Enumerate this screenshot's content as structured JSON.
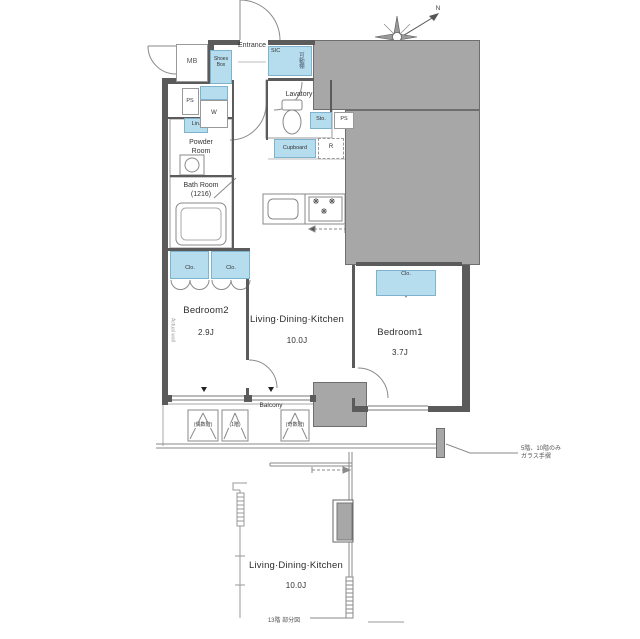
{
  "colors": {
    "wall": "#5b5b5b",
    "gray": "#a7a7a7",
    "blue": "#b6ddee",
    "blueBorder": "#7fb2cc",
    "line": "#8a8a8a",
    "text": "#333333"
  },
  "compass": {
    "north_label": "N"
  },
  "upper_plan": {
    "entrance": "Entrance",
    "mb": "MB",
    "shoes_box": "Shoes Box",
    "sic": "SIC",
    "sic_shelf": "可動棚",
    "lavatory": "Lavatory",
    "ps_left": "PS",
    "ps_right": "PS",
    "washer": "W",
    "linen": "Lin.",
    "powder_room": "Powder\nRoom",
    "bath_room": "Bath Room\n(1216)",
    "storage": "Sto.",
    "cupboard": "Cupboard",
    "fridge": "R",
    "burner_glyph": "❋",
    "closet_b2_left": "Clo.",
    "closet_b2_right": "Clo.",
    "closet_b1": "Clo.",
    "bedroom2_name": "Bedroom2",
    "bedroom2_size": "2.9J",
    "ldk_name": "Living·Dining·Kitchen",
    "ldk_size": "10.0J",
    "bedroom1_name": "Bedroom1",
    "bedroom1_size": "3.7J",
    "balcony": "Balcony",
    "hatch_even": "(偶数階)",
    "hatch_first": "(1階)",
    "hatch_odd": "(奇数階)",
    "railing_note": "5階、10階のみ\nガラス手摺",
    "wall_note": "Actual wall"
  },
  "lower_plan": {
    "ldk_name": "Living·Dining·Kitchen",
    "ldk_size": "10.0J",
    "caption": "13階 部分図"
  }
}
